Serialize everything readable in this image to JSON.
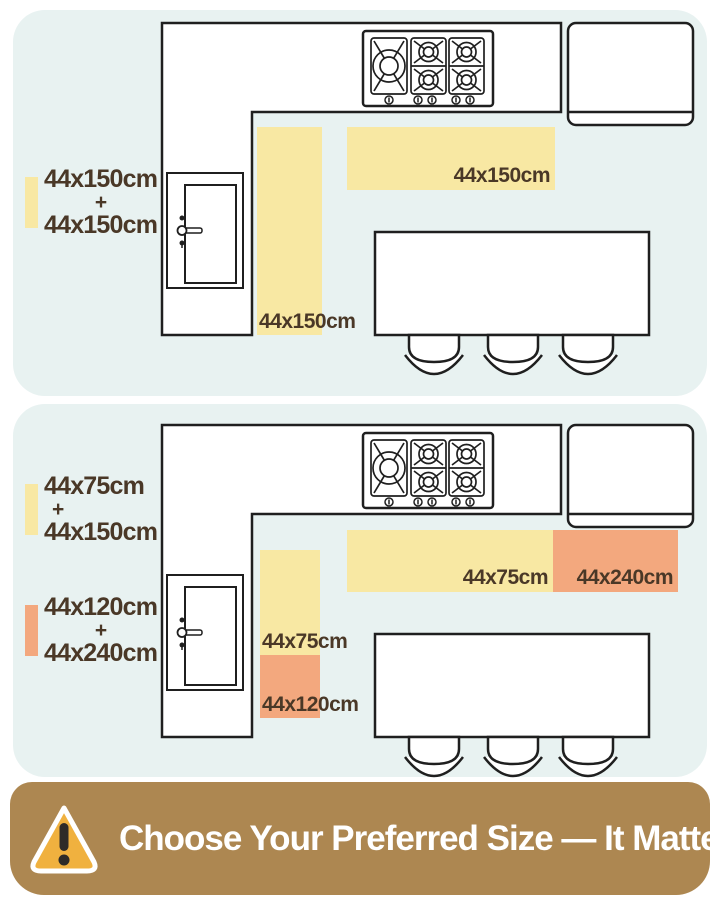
{
  "top_panel": {
    "legend": {
      "line1": "44x150cm",
      "plus": "+",
      "line2": "44x150cm"
    },
    "horizontal_rug_label": "44x150cm",
    "vertical_rug_label": "44x150cm"
  },
  "bottom_panel": {
    "legend_yellow": {
      "line1": "44x75cm",
      "plus": "+",
      "line2": "44x150cm"
    },
    "legend_orange": {
      "line1": "44x120cm",
      "plus": "+",
      "line2": "44x240cm"
    },
    "h_yellow_rug_label": "44x75cm",
    "h_orange_rug_label": "44x240cm",
    "v_yellow_rug_label": "44x75cm",
    "v_orange_rug_label": "44x120cm"
  },
  "banner": {
    "text": "Choose Your Preferred Size — It Matters"
  },
  "icons": {
    "warning": "warning-triangle-icon",
    "cooktop": "gas-cooktop-icon",
    "refrigerator": "refrigerator-icon",
    "door": "door-icon",
    "island": "kitchen-island",
    "chair": "chair-icon"
  },
  "colors": {
    "panel_bg": "#e8f2f1",
    "rug_yellow": "#f8e8a3",
    "rug_orange": "#f3a87e",
    "label_text": "#4a3827",
    "outline": "#1f1f1f",
    "banner_bg": "#ad8751",
    "banner_text": "#ffffff",
    "warning_gold": "#f0b13f",
    "warning_mark": "#2e2b28"
  }
}
